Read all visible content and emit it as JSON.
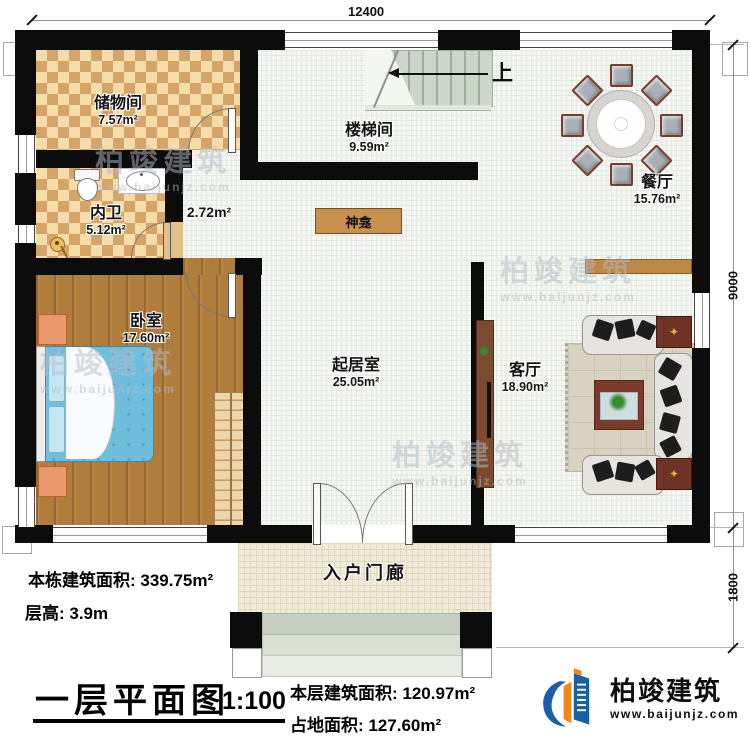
{
  "dimensions": {
    "top_width": "12400",
    "right_depth": "9000",
    "right_porch_depth": "1800"
  },
  "rooms": {
    "storage": {
      "name": "储物间",
      "area": "7.57m²"
    },
    "bathroom": {
      "name": "内卫",
      "area": "5.12m²"
    },
    "bedroom": {
      "name": "卧室",
      "area": "17.60m²"
    },
    "stairwell": {
      "name": "楼梯间",
      "area": "9.59m²"
    },
    "hallway": {
      "area": "2.72m²"
    },
    "living": {
      "name": "起居室",
      "area": "25.05m²"
    },
    "dining": {
      "name": "餐厅",
      "area": "15.76m²"
    },
    "lounge": {
      "name": "客厅",
      "area": "18.90m²"
    },
    "porch": {
      "name": "入户门廊"
    }
  },
  "fixtures": {
    "shrine_label": "神龛",
    "stairs_up_label": "上"
  },
  "title_block": {
    "plan_title": "一层平面图",
    "scale": "1:100",
    "building_total_area": "本栋建筑面积: 339.75m²",
    "floor_height": "层高: 3.9m",
    "floor_area": "本层建筑面积: 120.97m²",
    "footprint_area": "占地面积: 127.60m²"
  },
  "branding": {
    "company": "柏竣建筑",
    "website": "www.baijunjz.com"
  },
  "watermark": {
    "brand": "柏竣建筑",
    "site": "www.baijunjz.com"
  },
  "colors": {
    "wall": "#0c0c0c",
    "tile_light": "#f5dda9",
    "tile_dark": "#d4a566",
    "wood_floor": "#b17d3d",
    "brand_blue": "#1a5fa8",
    "brand_orange": "#f08519"
  }
}
